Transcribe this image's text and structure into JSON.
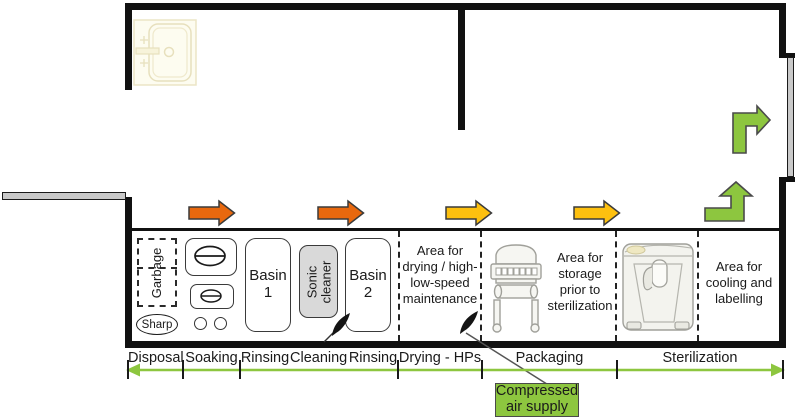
{
  "diagram_type": "floor-plan workflow of a sterilization / instrument reprocessing unit",
  "stations": {
    "garbage": "Garbage",
    "sharp": "Sharp",
    "basin1": "Basin 1",
    "sonic": "Sonic cleaner",
    "basin2": "Basin 2"
  },
  "areas": {
    "drying_lines": [
      "Area for",
      "drying / high-",
      "low-speed",
      "maintenance"
    ],
    "storage_lines": [
      "Area for",
      "storage",
      "prior to",
      "sterilization"
    ],
    "cooling_lines": [
      "Area for",
      "cooling and",
      "labelling"
    ]
  },
  "zones": [
    "Disposal",
    "Soaking",
    "Rinsing",
    "Cleaning",
    "Rinsing",
    "Drying - HPs",
    "Packaging",
    "Sterilization"
  ],
  "annotation": {
    "compressed_air_lines": [
      "Compressed",
      "air supply"
    ]
  },
  "icons": {
    "sink": "sink-icon",
    "door_left": "door-leaf-icon",
    "door_right": "door-leaf-icon",
    "flow_right_orange": "arrow-right-icon",
    "flow_right_yellow": "arrow-right-icon",
    "flow_turn_up": "arrow-turn-up-icon",
    "flow_turn_right": "arrow-turn-right-icon",
    "air_nozzle": "air-nozzle-icon",
    "packaging_machine": "packaging-machine-icon",
    "sterilizer": "sterilizer-machine-icon"
  },
  "colors": {
    "wall": "#111111",
    "orange_arrow": "#e8680e",
    "yellow_arrow": "#fdc00f",
    "green": "#8dc63f",
    "door_gray": "#c9c9c9",
    "sonic_fill": "#d9d9d9",
    "machine_line": "#a0a09a"
  }
}
